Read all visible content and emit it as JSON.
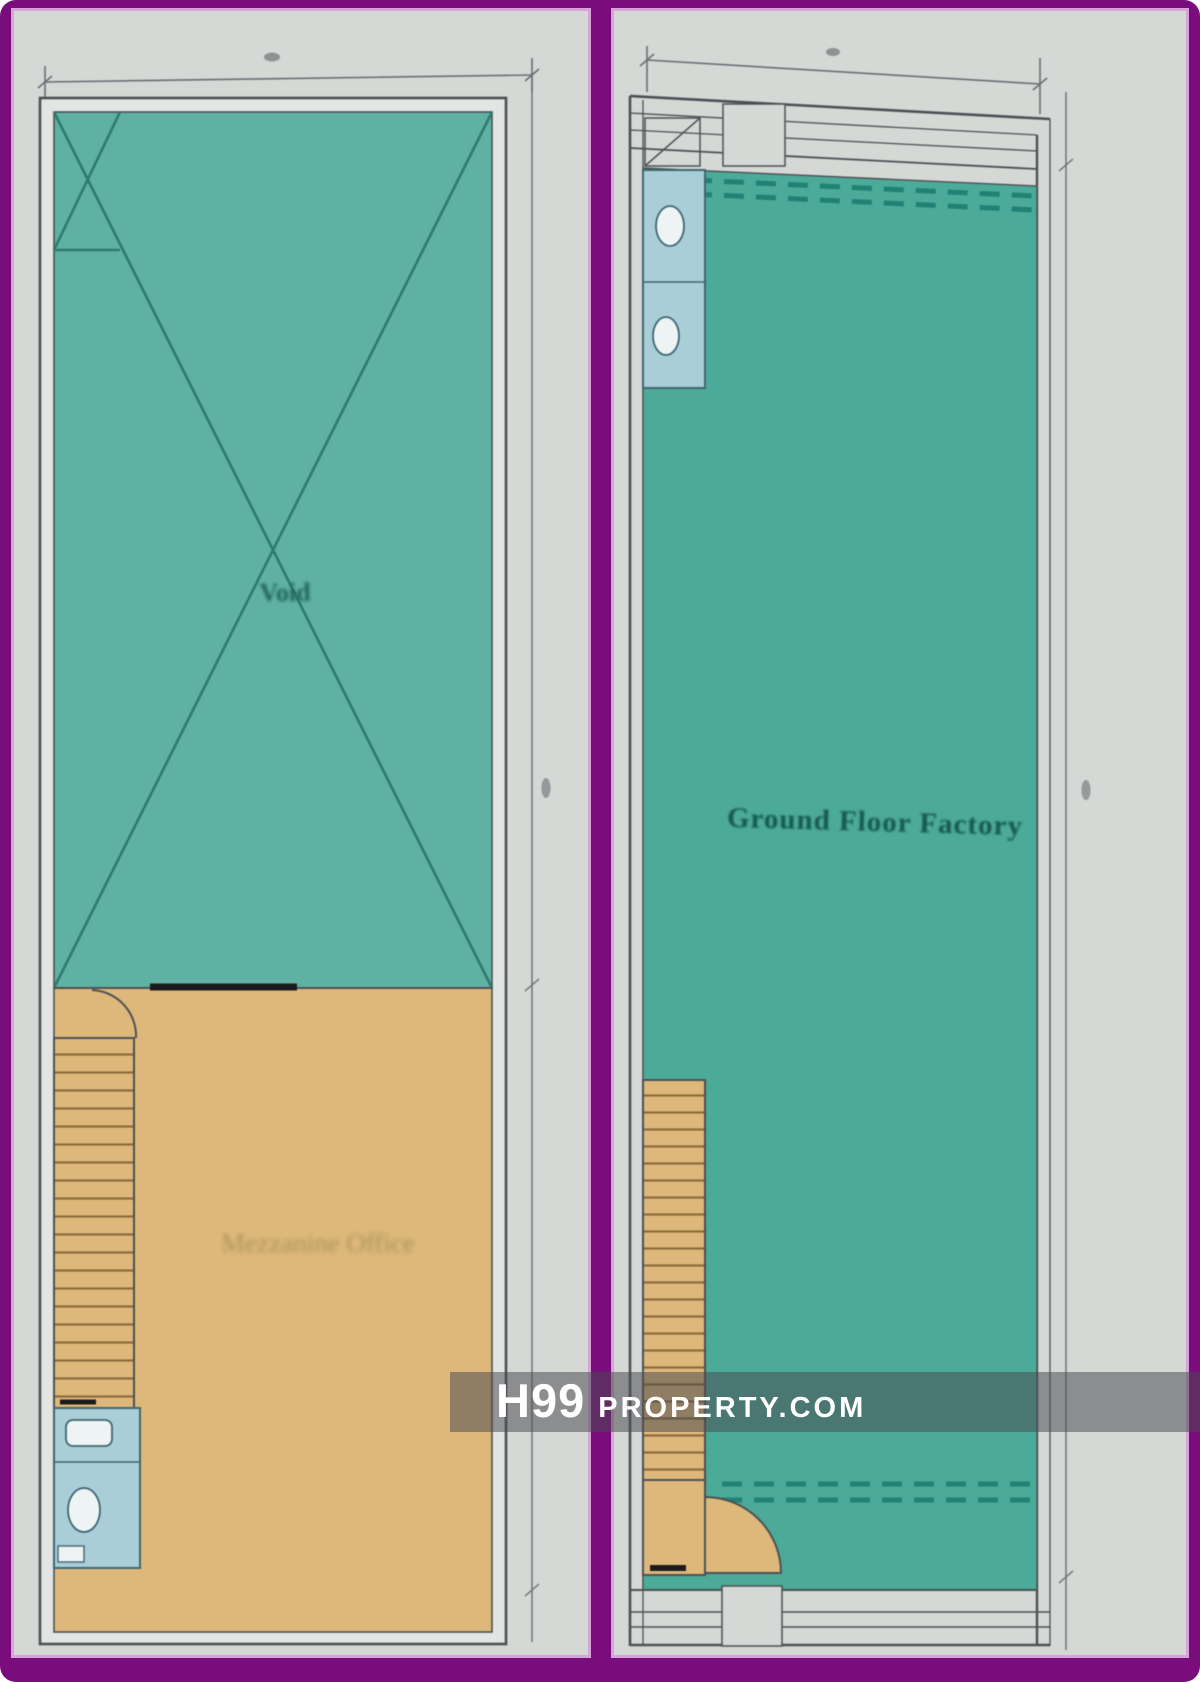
{
  "frame": {
    "color": "#7a0d7c",
    "inner_line_color": "#d9a2d9",
    "panel_bg": "#d6d8d6"
  },
  "left_plan": {
    "void_label": "Void",
    "office_label": "Mezzanine Office",
    "colors": {
      "void_fill": "#5fb2a3",
      "office_fill": "#deb87b",
      "toilet_fill": "#a9ced8",
      "cross_line": "#2d7a6e"
    }
  },
  "right_plan": {
    "factory_label": "Ground Floor Factory",
    "colors": {
      "factory_fill": "#4caa99",
      "stair_fill": "#deb87b",
      "toilet_fill": "#a9ced8",
      "shutter_dash": "#1f8274"
    }
  },
  "watermark": {
    "logo": "H99",
    "site": "PROPERTY.COM",
    "text_color": "#ffffff"
  }
}
